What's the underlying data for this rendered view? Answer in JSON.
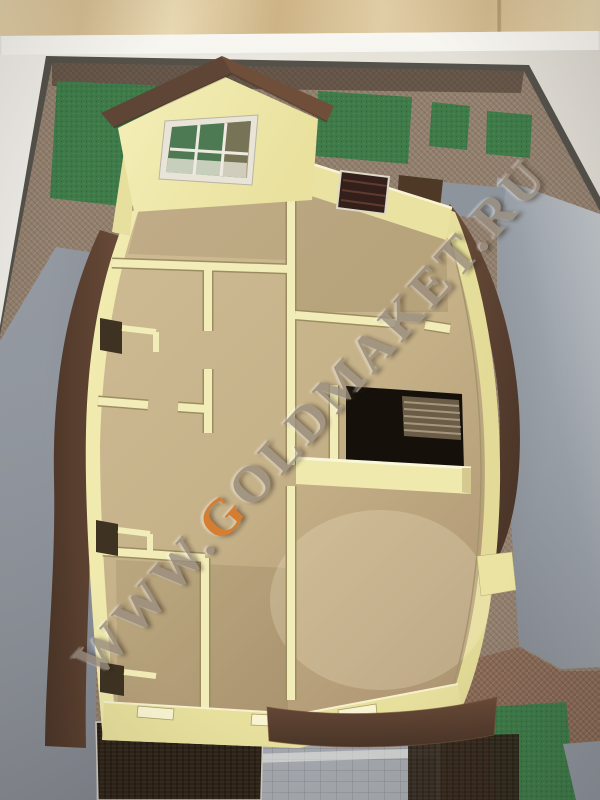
{
  "photo": {
    "subject": "architectural-scale-model-house-floor-plan",
    "watermark": {
      "prefix": "WWW.",
      "highlight": "G",
      "rest": "OLDMAKET.RU",
      "full": "WWW.GOLDMAKET.RU"
    }
  },
  "palette": {
    "board": "#e9e6df",
    "wood": "#d9c59e",
    "frame": "#54504a",
    "brick": "#93806e",
    "brickRed": "#8a6a56",
    "grass": "#3e7b49",
    "road": "#8f959e",
    "roadLight": "#bac0c6",
    "cream": "#eee7a6",
    "creamLight": "#f7f2cd",
    "floor": "#c9b58d",
    "floorDark": "#ad9770",
    "brown": "#5e4434",
    "brownLight": "#6f4f3a",
    "shingle": "#2e2318",
    "stairDark": "#15100a",
    "watermark": "#9b8f80",
    "watermarkOrange": "#d9731f"
  }
}
